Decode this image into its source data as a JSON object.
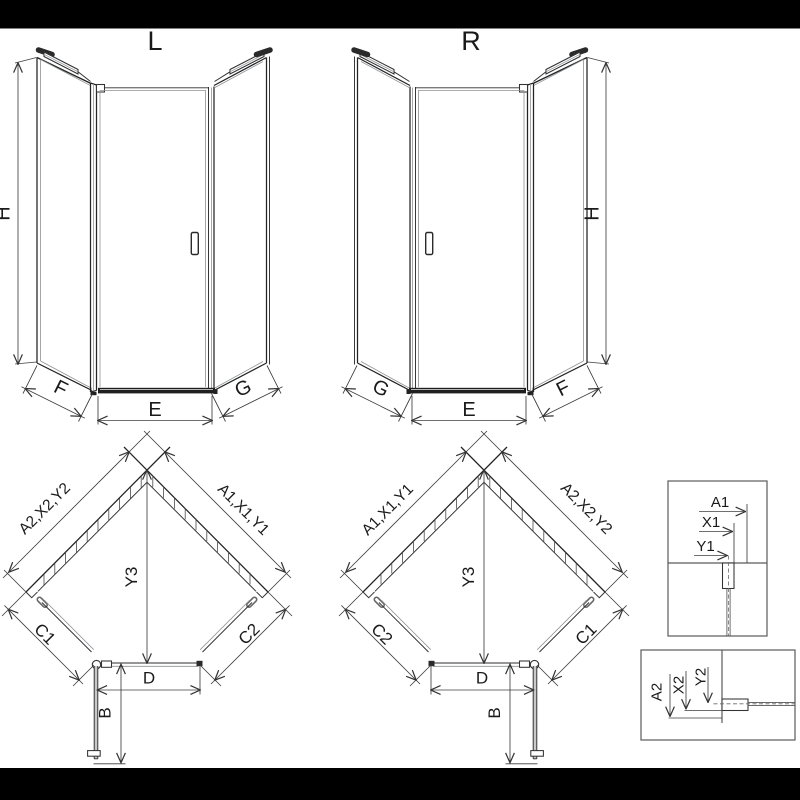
{
  "front_left": {
    "title": "L",
    "height": "H",
    "side_left": "F",
    "door": "E",
    "side_right": "G"
  },
  "front_right": {
    "title": "R",
    "height": "H",
    "side_left": "G",
    "door": "E",
    "side_right": "F"
  },
  "plan_left": {
    "wall_left": "A2,X2,Y2",
    "wall_right": "A1,X1,Y1",
    "depth": "Y3",
    "panel_left": "C1",
    "panel_right": "C2",
    "door": "D",
    "swing": "B"
  },
  "plan_right": {
    "wall_left": "A1,X1,Y1",
    "wall_right": "A2,X2,Y2",
    "depth": "Y3",
    "panel_left": "C2",
    "panel_right": "C1",
    "door": "D",
    "swing": "B"
  },
  "detail_top": {
    "dim_outer": "A1",
    "dim_mid": "X1",
    "dim_inner": "Y1"
  },
  "detail_bottom": {
    "dim_outer": "A2",
    "dim_mid": "X2",
    "dim_inner": "Y2"
  },
  "colors": {
    "line": "#232323",
    "glass": "#8d9296",
    "dimension": "#3f3f3f",
    "letterbox": "#000000",
    "background": "#ffffff"
  }
}
